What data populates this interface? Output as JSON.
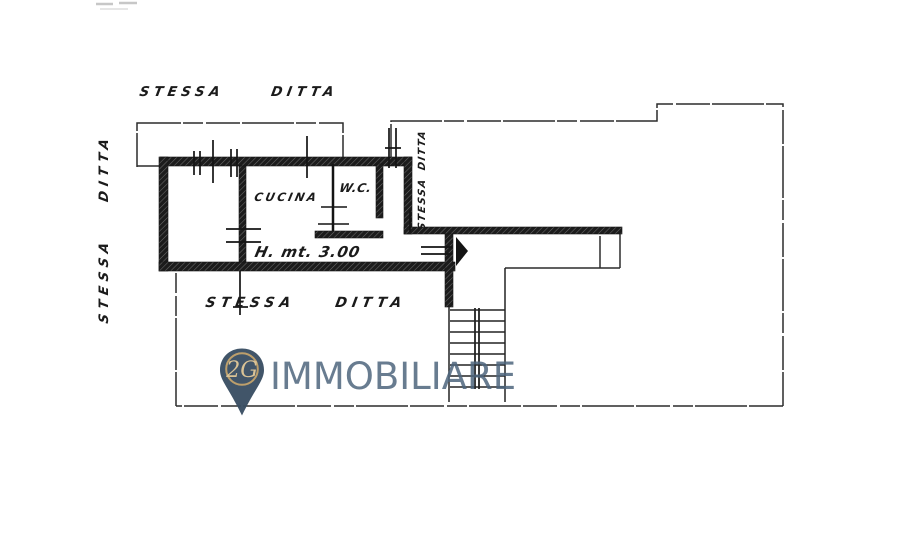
{
  "annotations": {
    "neighbor_top": {
      "word1": "STESSA",
      "word2": "DITTA"
    },
    "neighbor_left": {
      "word1": "STESSA",
      "word2": "DITTA"
    },
    "neighbor_right": {
      "word1": "STESSA",
      "word2": "DITTA"
    },
    "neighbor_bottom": {
      "word1": "STESSA",
      "word2": "DITTA"
    },
    "room_kitchen": "CUCINA",
    "room_wc": "W.C.",
    "ceiling_height": "H. mt. 3.00"
  },
  "watermark": {
    "monogram": "2G",
    "brand": "IMMOBILIARE",
    "pin_color": "#3a4f63",
    "ring_color": "#bb9c66",
    "monogram_color": "#d9c192",
    "brand_color": "#4d657c"
  },
  "colors": {
    "ink": "#1a1a1a",
    "paper": "#ffffff"
  }
}
